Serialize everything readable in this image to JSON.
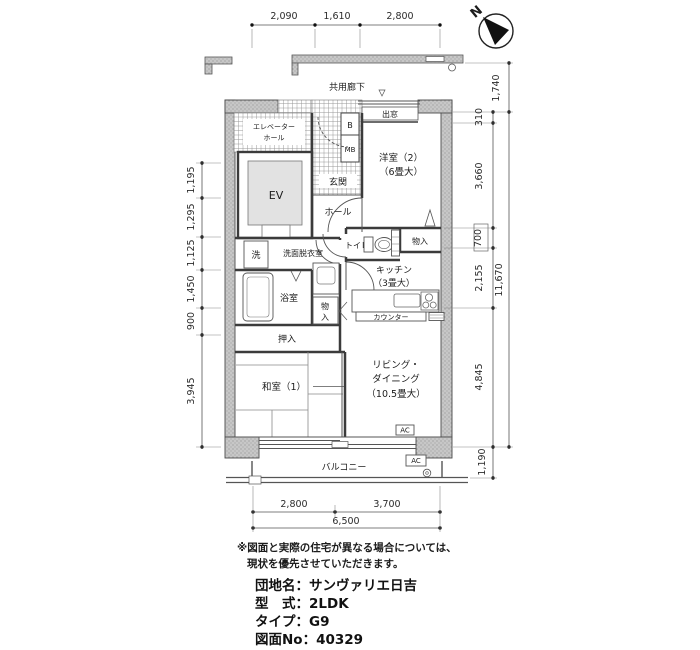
{
  "compass": {
    "north_label": "N"
  },
  "plan": {
    "corridor": "共用廊下",
    "elevator_hall_line1": "エレベーター",
    "elevator_hall_line2": "ホール",
    "elevator": "EV",
    "meter_box_b": "B",
    "meter_box_mb": "MB",
    "entrance": "玄関",
    "bay_window": "出窓",
    "hall": "ホール",
    "western_room2_name": "洋室（2）",
    "western_room2_size": "（6畳大）",
    "toilet": "トイレ",
    "closet_hall": "物入",
    "kitchen_name": "キッチン",
    "kitchen_size": "（3畳大）",
    "counter": "カウンター",
    "washing_machine": "洗",
    "washroom": "洗面脱衣室",
    "bathroom": "浴室",
    "closet_bath_char1": "物",
    "closet_bath_char2": "入",
    "oshiire": "押入",
    "japanese_room1": "和室（1）",
    "living_line1": "リビング・",
    "living_line2": "ダイニング",
    "living_size": "（10.5畳大）",
    "ac_indoor": "AC",
    "ac_outdoor": "AC",
    "balcony": "バルコニー"
  },
  "dimensions": {
    "top": [
      "2,090",
      "1,610",
      "2,800"
    ],
    "left": [
      "1,195",
      "1,295",
      "1,125",
      "1,450",
      "900",
      "3,945"
    ],
    "right": [
      "1,740",
      "310",
      "3,660",
      "700",
      "2,155",
      "4,845",
      "1,190"
    ],
    "right_total": "11,670",
    "bottom": [
      "2,800",
      "3,700"
    ],
    "bottom_total": "6,500"
  },
  "notes": {
    "line1": "※図面と実際の住宅が異なる場合については、",
    "line2": "現状を優先させていただきます。"
  },
  "title_block": {
    "rows": [
      {
        "label": "団地名：",
        "value": "サンヴァリエ日吉"
      },
      {
        "label": "型　式：",
        "value": "2LDK"
      },
      {
        "label": "タイプ：",
        "value": "G9"
      },
      {
        "label": "図面No：",
        "value": "40329"
      }
    ]
  }
}
